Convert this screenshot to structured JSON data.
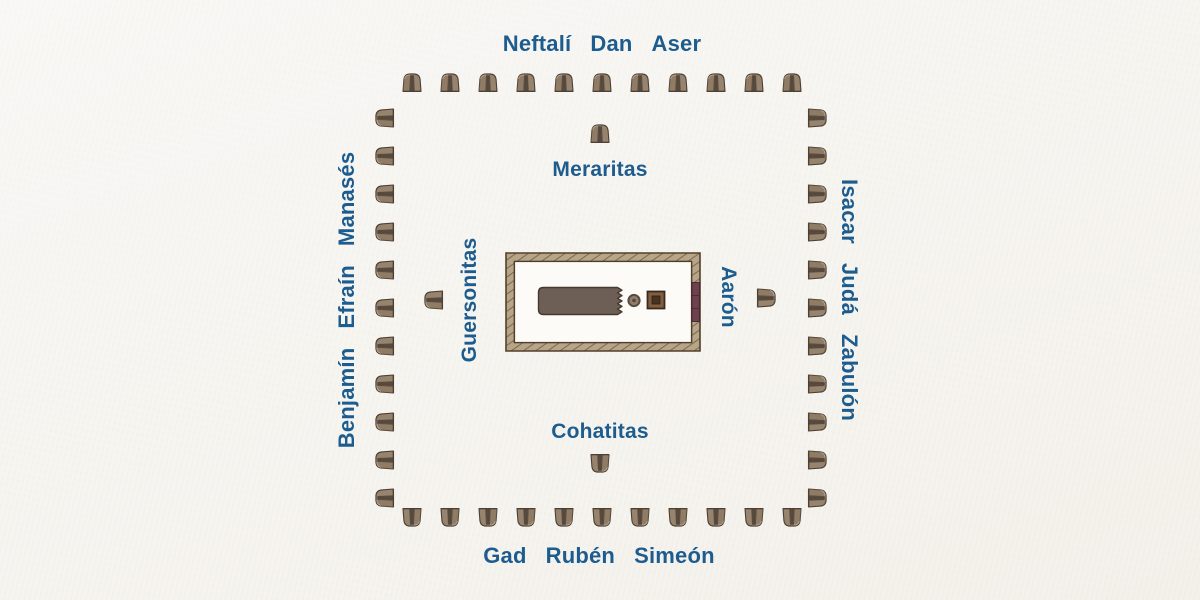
{
  "camp": {
    "outer_tribes": {
      "top": [
        "Neftalí",
        "Dan",
        "Aser"
      ],
      "right": [
        "Isacar",
        "Judá",
        "Zabulón"
      ],
      "bottom": [
        "Gad",
        "Rubén",
        "Simeón"
      ],
      "left": [
        "Benjamín",
        "Efraín",
        "Manasés"
      ]
    },
    "inner_groups": {
      "top": "Meraritas",
      "right": "Aarón",
      "bottom": "Cohatitas",
      "left": "Guersonitas"
    },
    "tents_per_outer_side": 11,
    "tents_per_inner_side": 1
  },
  "colors": {
    "background": "#f5f3ee",
    "label_blue": "#1d5c8e",
    "tent_body": "#97846f",
    "tent_opening": "#5d4f42",
    "tent_outline": "#4c3f33",
    "courtyard_wall": "#b7a58a",
    "courtyard_wall_stroke": "#54402a",
    "courtyard_floor": "#fcfbf7",
    "gate_maroon": "#6e4150",
    "tabernacle_fill": "#6d5f56",
    "altar_fill": "#7f5f40",
    "laver_fill": "#8d7d6c"
  }
}
